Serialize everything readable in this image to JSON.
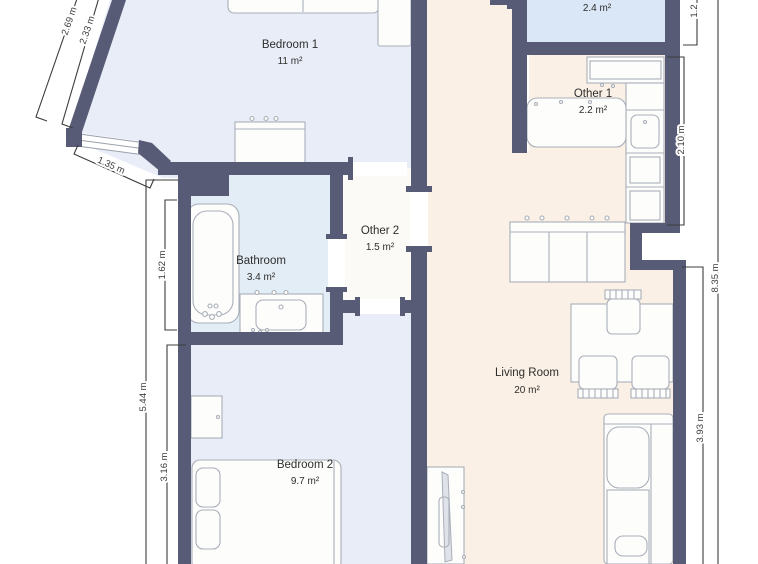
{
  "plan": {
    "rooms": [
      {
        "id": "bedroom1",
        "name": "Bedroom 1",
        "area": "11 m²"
      },
      {
        "id": "bathroom",
        "name": "Bathroom",
        "area": "3.4 m²"
      },
      {
        "id": "other2",
        "name": "Other 2",
        "area": "1.5 m²"
      },
      {
        "id": "bedroom2",
        "name": "Bedroom 2",
        "area": "9.7 m²"
      },
      {
        "id": "living_room",
        "name": "Living Room",
        "area": "20 m²"
      },
      {
        "id": "other1",
        "name": "Other 1",
        "area": "2.2 m²"
      },
      {
        "id": "room_top_right",
        "name": "",
        "area": "2.4 m²"
      }
    ],
    "dimensions": [
      {
        "id": "diag-outer",
        "label": "2.69 m"
      },
      {
        "id": "diag-inner",
        "label": "2.33 m"
      },
      {
        "id": "window-width",
        "label": "1.35 m"
      },
      {
        "id": "bath-left",
        "label": "1.62 m"
      },
      {
        "id": "left-total",
        "label": "5.44 m"
      },
      {
        "id": "bedroom2-left",
        "label": "3.16 m"
      },
      {
        "id": "kitchen-right",
        "label": "2.10 m"
      },
      {
        "id": "top-right-partial",
        "label": "1.2"
      },
      {
        "id": "living-right",
        "label": "3.93 m"
      },
      {
        "id": "right-total",
        "label": "8.35 m"
      }
    ],
    "colors": {
      "bg": "#ffffff",
      "wall": "#575b76",
      "bedBlue": "#e9edf8",
      "bathBlue": "#e3edf5",
      "topBlue": "#d9e7f6",
      "peach": "#faf0e5",
      "neutral": "#fbfaf6",
      "furnFill": "#fdfdfc",
      "furnStroke": "#a9aeb9",
      "dim": "#3c3c3c",
      "label": "#2e2e2e"
    }
  }
}
